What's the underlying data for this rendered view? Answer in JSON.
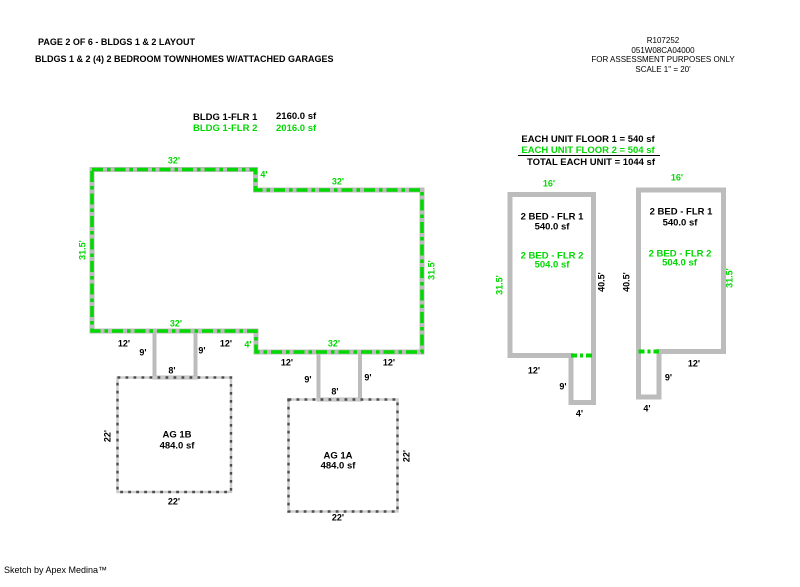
{
  "colors": {
    "green": "#00D800",
    "outline_gray": "#BCBCBC",
    "garage_dot_gray": "#4E4E4E"
  },
  "header": {
    "line1": "PAGE 2 OF 6 - BLDGS 1 & 2 LAYOUT",
    "line2": "BLDGS 1 & 2 (4) 2 BEDROOM TOWNHOMES W/ATTACHED GARAGES"
  },
  "title_block": {
    "record_id": "R107252",
    "map_taxlot": "051W08CA04000",
    "purpose": "FOR ASSESSMENT PURPOSES ONLY",
    "scale": "SCALE 1\" = 20'"
  },
  "legend": {
    "flr1_label": "BLDG 1-FLR 1",
    "flr1_area": "2160.0 sf",
    "flr2_label": "BLDG 1-FLR 2",
    "flr2_area": "2016.0 sf"
  },
  "unit_summary": {
    "floor1": "EACH UNIT FLOOR 1 = 540 sf",
    "floor2": "EACH UNIT FLOOR 2 = 504 sf",
    "total": "TOTAL EACH UNIT = 1044 sf"
  },
  "main_building": {
    "dims": {
      "top_left": "32'",
      "top_step": "4'",
      "top_right": "32'",
      "left_side": "31.5'",
      "right_side": "31.5'",
      "bottom_left": "32'",
      "bottom_step": "4'",
      "bottom_right": "32'"
    },
    "breezeway_left": {
      "left": "12'",
      "left_depth": "9'",
      "door": "8'",
      "right_depth": "9'",
      "right": "12'"
    },
    "breezeway_right": {
      "left": "12'",
      "left_depth": "9'",
      "door": "8'",
      "right_depth": "9'",
      "right": "12'"
    }
  },
  "garages": {
    "left": {
      "name": "AG 1B",
      "area": "484.0 sf",
      "side": "22'",
      "bottom": "22'"
    },
    "right": {
      "name": "AG 1A",
      "area": "484.0 sf",
      "side": "22'",
      "bottom": "22'"
    }
  },
  "units": {
    "left": {
      "top": "16'",
      "flr1": "2 BED - FLR 1",
      "flr1_area": "540.0 sf",
      "flr2": "2 BED - FLR 2",
      "flr2_area": "504.0 sf",
      "left_side": "31.5'",
      "right_side": "40.5'",
      "bottom": "12'",
      "tab_depth": "9'",
      "tab_width": "4'"
    },
    "right": {
      "top": "16'",
      "flr1": "2 BED - FLR 1",
      "flr1_area": "540.0 sf",
      "flr2": "2 BED - FLR 2",
      "flr2_area": "504.0 sf",
      "left_side": "40.5'",
      "right_side": "31.5'",
      "bottom": "12'",
      "tab_depth": "9'",
      "tab_width": "4'"
    }
  },
  "footer": {
    "credit": "Sketch by Apex Medina™"
  }
}
